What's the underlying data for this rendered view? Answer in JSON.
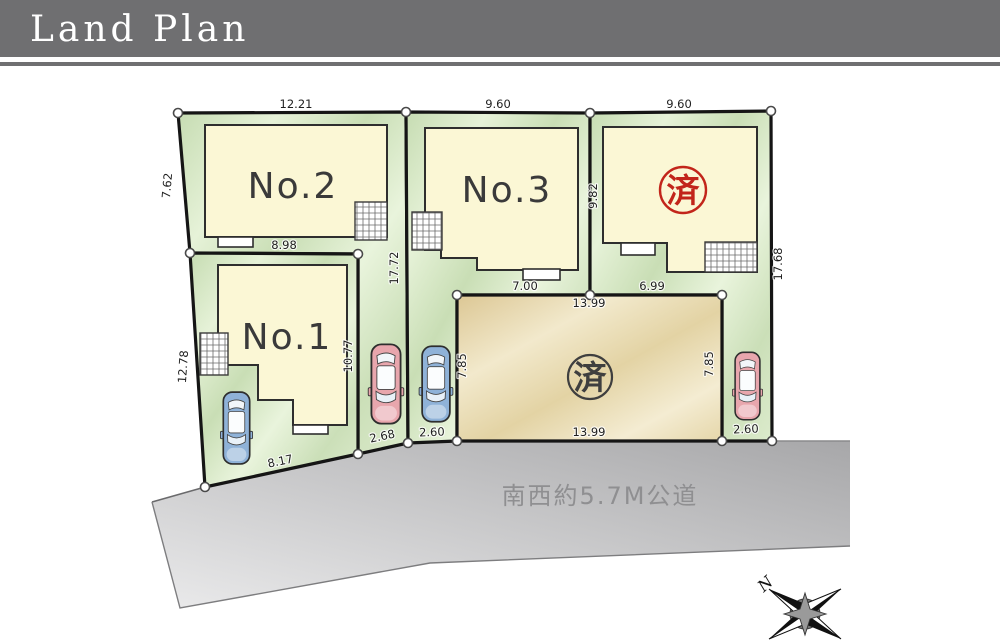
{
  "header": {
    "title": "Land Plan"
  },
  "lots": {
    "no1": {
      "label": "No.1",
      "status": "available"
    },
    "no2": {
      "label": "No.2",
      "status": "available"
    },
    "no3": {
      "label": "No.3",
      "status": "available"
    },
    "east": {
      "label": "済",
      "status": "sold"
    },
    "center": {
      "label": "済",
      "status": "sold"
    }
  },
  "measurements": {
    "no2_top": "12.21",
    "no2_left": "7.62",
    "no2_bottom": "8.98",
    "no2_right": "17.72",
    "no2_driveway_side": "10.77",
    "no2_frontage": "2.68",
    "no1_left": "12.78",
    "no1_frontage": "8.17",
    "no3_top": "9.60",
    "no3_bottom": "7.00",
    "no3_frontage": "2.60",
    "east_top": "9.60",
    "east_left": "9.82",
    "east_bottom": "6.99",
    "east_right": "17.68",
    "east_frontage": "2.60",
    "center_top": "13.99",
    "center_bottom": "13.99",
    "center_left": "7.85",
    "center_right": "7.85"
  },
  "road": {
    "label": "南西約5.7M公道"
  },
  "compass": {
    "north": "N"
  },
  "colors": {
    "header_gray": "#6f6f71",
    "lot_green": "#cfe3c0",
    "house_cream": "#fbf7d5",
    "center_tan": "#e7d8ab",
    "road_gray_dark": "#a7a7a9",
    "road_gray_light": "#e6e6e7",
    "sold_red": "#c2251a",
    "stamp_dark": "#3f3f3f",
    "car_blue": "#8fb2d8",
    "car_pink": "#e8a6ad",
    "outline": "#151515"
  }
}
